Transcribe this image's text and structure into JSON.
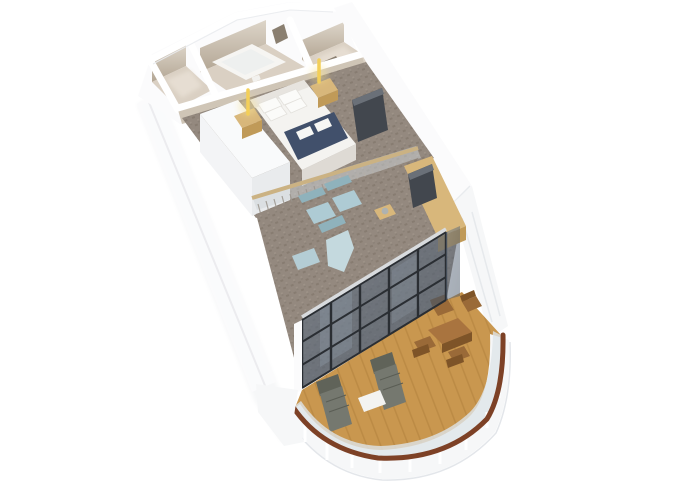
{
  "scene": {
    "type": "3d-isometric-floorplan-render",
    "items": [
      "entry-hall",
      "bathroom",
      "bathtub",
      "walkin-closet",
      "bedroom",
      "double-bed",
      "bed-runner",
      "pillows",
      "nightstand-left",
      "nightstand-right",
      "pendant-light-left",
      "pendant-light-right",
      "wardrobe",
      "tv-panel-bedroom",
      "sheer-curtain",
      "glass-partition",
      "living-room",
      "armchair-1",
      "armchair-2",
      "chaise-lounge",
      "ottoman",
      "sideboard-desk",
      "tv-panel-living",
      "window-facade",
      "balcony-deck",
      "dining-table",
      "dining-chairs",
      "sun-lounger-1",
      "sun-lounger-2",
      "side-table-white",
      "balcony-railing",
      "ship-hull-walls"
    ]
  },
  "colors": {
    "background": "#ffffff",
    "wall_white": "#fbfbfc",
    "wall_white_shade": "#eef0f2",
    "wall_edge": "#e6e8eb",
    "wall_beige_dark": "#b3a694",
    "wall_beige_light": "#ddd5c9",
    "wall_front_band": "#cfc5b6",
    "floor_service": "#dad0c3",
    "floor_service_light": "#e9e1d6",
    "door_gap": "#8a7f70",
    "tub_white": "#f6f5f2",
    "tub_inner": "#eef0ef",
    "carpet_base": "#94897f",
    "carpet_dark": "#7c7166",
    "carpet_light": "#a89d92",
    "bed_white": "#f4f3f0",
    "bed_side": "#dedad4",
    "bed_head": "#e7e4df",
    "pillow_white": "#fbfbf9",
    "pillow_edge": "#e3e1dc",
    "bed_runner_navy": "#41506b",
    "towel_white": "#f7f7f4",
    "wood_light": "#d8b77b",
    "wood_mid": "#c09a58",
    "lamp_glow": "#f3cf58",
    "lamp_halo": "#f8e49a",
    "tv_dark": "#42474e",
    "tv_edge": "#6a7078",
    "wardrobe_white": "#f9fafb",
    "wardrobe_side": "#e9ebed",
    "curtain_grey": "#9b958d",
    "curtain_grey_light": "#b5b0a8",
    "partition_glass": "#cdd4d8",
    "partition_cap_wood": "#cbb283",
    "chair_blue": "#aecbd4",
    "chair_blue_dark": "#8fb2bc",
    "chaise_blue": "#c4d9de",
    "ottoman_blue": "#b4cdd5",
    "glass_tint": "#5f6e80",
    "glass_streak": "#9aa9b8",
    "glass_frame": "#2a2e33",
    "glass_header": "#d8dbde",
    "deck_wood": "#c9974f",
    "deck_plank": "#ae7c3a",
    "outdoor_wood": "#a9743f",
    "outdoor_wood_dark": "#7e5428",
    "outdoor_chair": "#9a6a38",
    "lounger_grey": "#75786f",
    "lounger_grey_dark": "#606359",
    "side_table_white": "#f3f3f1",
    "handrail_brown": "#7d4126",
    "balustrade_glass": "#dfe5e8",
    "hull_white": "#f6f7f8",
    "hull_shade": "#e3e6ea"
  }
}
